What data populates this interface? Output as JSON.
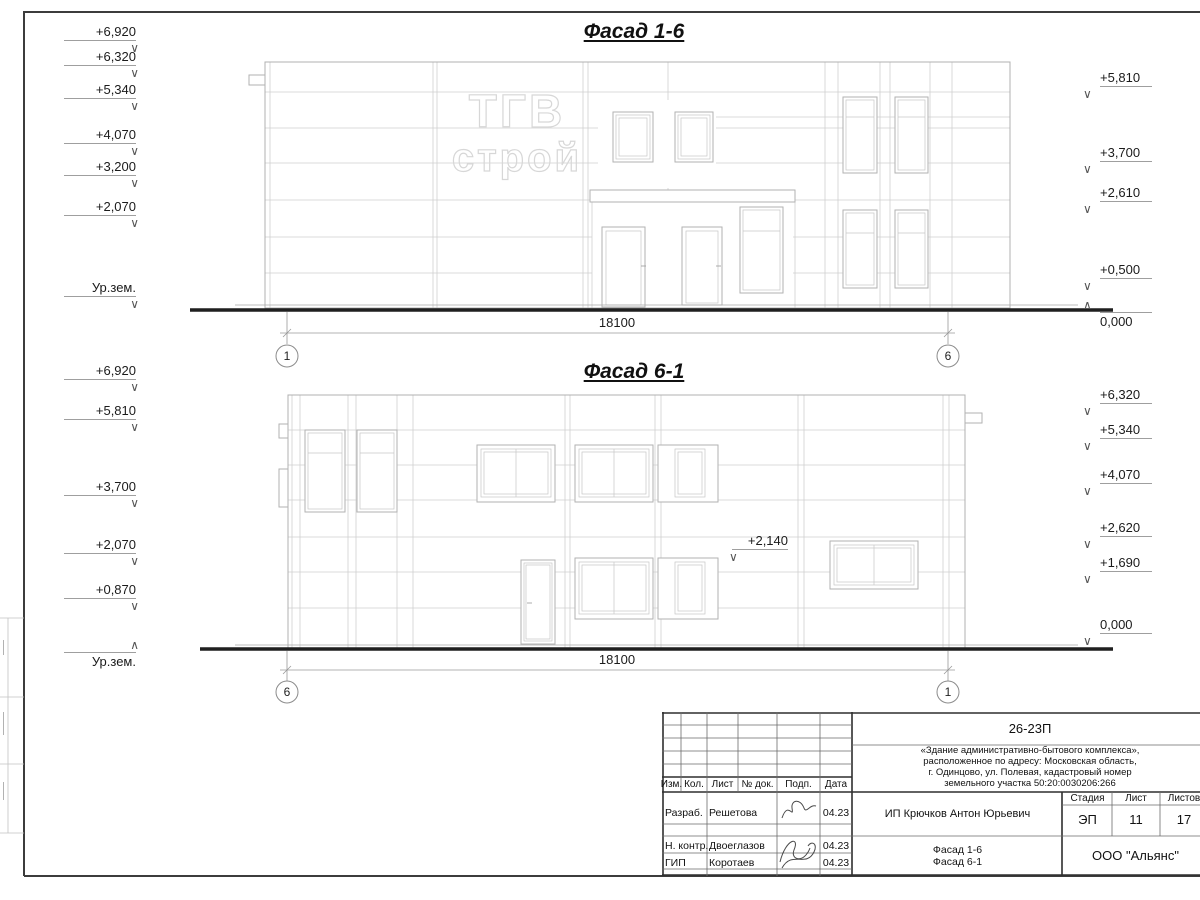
{
  "sheet": {
    "facade_top": {
      "title": "Фасад 1-6",
      "watermark_line1": "ТГВ",
      "watermark_line2": "строй",
      "dimension": "18100",
      "axis_left": "1",
      "axis_right": "6",
      "left_marks": [
        "+6,920",
        "+6,320",
        "+5,340",
        "+4,070",
        "+3,200",
        "+2,070"
      ],
      "ground_label": "Ур.зем.",
      "right_marks": [
        "+5,810",
        "+3,700",
        "+2,610",
        "+0,500",
        "0,000"
      ]
    },
    "facade_bottom": {
      "title": "Фасад 6-1",
      "dimension": "18100",
      "axis_left": "6",
      "axis_right": "1",
      "inner_mark": "+2,140",
      "left_marks": [
        "+6,920",
        "+5,810",
        "+3,700",
        "+2,070",
        "+0,870"
      ],
      "ground_label": "Ур.зем.",
      "right_marks": [
        "+6,320",
        "+5,340",
        "+4,070",
        "+2,620",
        "+1,690",
        "0,000"
      ]
    },
    "title_block": {
      "code": "26-23П",
      "description_line1": "«Здание административно-бытового комплекса»,",
      "description_line2": "расположенное по адресу: Московская область,",
      "description_line3": "г. Одинцово, ул. Полевая, кадастровый номер",
      "description_line4": "земельного участка 50:20:0030206:266",
      "col_izm": "Изм.",
      "col_kol": "Кол.",
      "col_list": "Лист",
      "col_ndok": "№ док.",
      "col_podp": "Подп.",
      "col_data": "Дата",
      "row1_role": "Разраб.",
      "row1_name": "Решетова",
      "row1_date": "04.23",
      "row2_role": "Н. контр.",
      "row2_name": "Двоеглазов",
      "row2_date": "04.23",
      "row3_role": "ГИП",
      "row3_name": "Коротаев",
      "row3_date": "04.23",
      "client": "ИП Крючков Антон Юрьевич",
      "stage_label": "Стадия",
      "list_label": "Лист",
      "listov_label": "Листов",
      "stage_value": "ЭП",
      "list_value": "11",
      "listov_value": "17",
      "subject_line1": "Фасад 1-6",
      "subject_line2": "Фасад 6-1",
      "company": "ООО \"Альянс\""
    }
  }
}
